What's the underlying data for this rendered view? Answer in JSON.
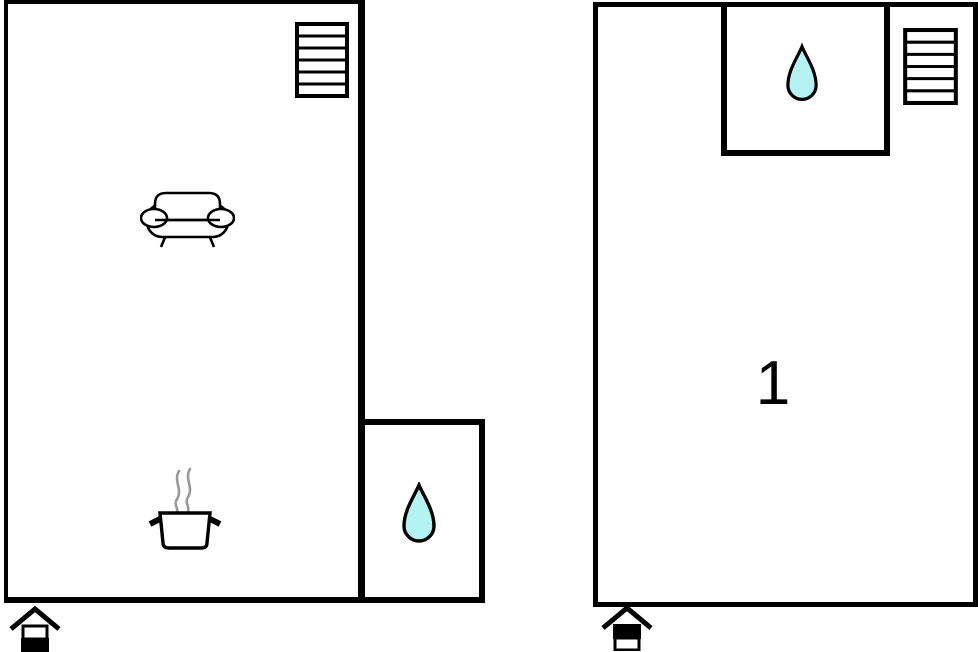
{
  "floorplan": {
    "left_plan": {
      "name": "ground floor plan",
      "rooms": [
        "living-kitchen area",
        "bathroom"
      ],
      "icons": [
        "stairs-icon",
        "sofa-icon",
        "cooking-pot-icon",
        "water-drop-icon",
        "floor-indicator-house-icon"
      ]
    },
    "right_plan": {
      "name": "upper floor plan",
      "room_label": "1",
      "rooms": [
        "bedroom 1",
        "bathroom"
      ],
      "icons": [
        "water-drop-icon",
        "stairs-icon",
        "floor-indicator-house-icon"
      ]
    },
    "colors": {
      "wall": "#000000",
      "water_drop_fill": "#b5f2f2",
      "water_drop_outline": "#000000",
      "steam": "#999999",
      "background": "#ffffff"
    }
  }
}
